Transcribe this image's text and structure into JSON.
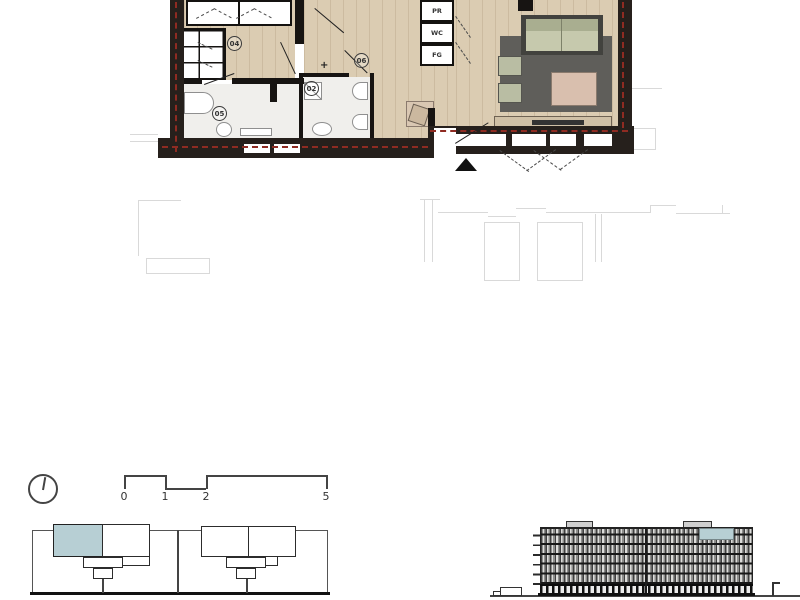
{
  "document": {
    "kind": "apartment-floor-plan-sheet",
    "views": [
      "unit-floor-plan",
      "north-arrow",
      "scale-bar",
      "key-plan",
      "building-elevation"
    ]
  },
  "floor_plan": {
    "room_labels": [
      {
        "number": "04",
        "room": "bedroom"
      },
      {
        "number": "06",
        "room": "hall"
      },
      {
        "number": "02",
        "room": "bathroom"
      },
      {
        "number": "05",
        "room": "bathroom"
      }
    ],
    "plus_marker": "+",
    "appliances": [
      {
        "label": "PR"
      },
      {
        "label": "WC"
      },
      {
        "label": "FG"
      }
    ]
  },
  "scale_bar": {
    "ticks": [
      "0",
      "1",
      "2",
      "5"
    ]
  },
  "icons": [
    {
      "name": "north-arrow-icon"
    },
    {
      "name": "entrance-triangle-icon"
    }
  ],
  "colors": {
    "exterior_wall": "#26201c",
    "insulation_dash": "#8f2b22",
    "wood_floor": "#dbccb2",
    "tile_floor": "#f0efec",
    "rug": "#5f5e5a",
    "sofa": "#c6c9ad",
    "coffee_table": "#d9bfae",
    "sideboard": "#cfc0a6",
    "unit_highlight": "#b7cfd4",
    "neighbor_outline": "#d9d9d9"
  }
}
